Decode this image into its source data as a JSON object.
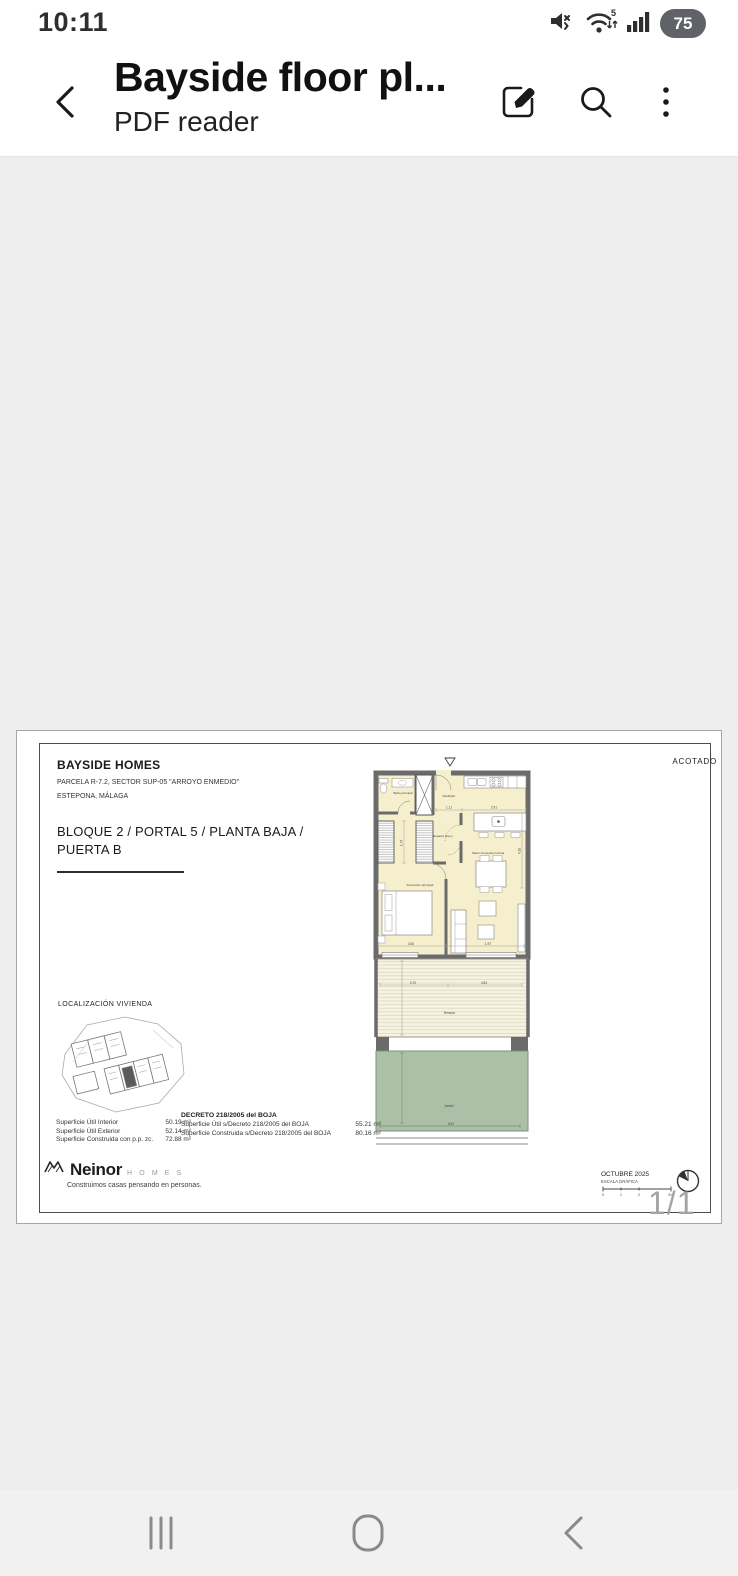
{
  "status_bar": {
    "time": "10:11",
    "battery_level": "75",
    "wifi_label": "5"
  },
  "header": {
    "title": "Bayside floor pl...",
    "subtitle": "PDF reader"
  },
  "viewer": {
    "page_indicator": "1/1"
  },
  "pdf": {
    "acotado": "ACOTADO",
    "project": {
      "name": "BAYSIDE HOMES",
      "address_line1": "PARCELA R-7.2, SECTOR SUP-05 \"ARROYO ENMEDIO\"",
      "address_line2": "ESTEPONA, MÁLAGA"
    },
    "unit": {
      "line1": "BLOQUE 2 / PORTAL 5 / PLANTA BAJA /",
      "line2": "PUERTA B"
    },
    "localizacion_title": "LOCALIZACIÓN VIVIENDA",
    "plan": {
      "rooms": {
        "bano": "Baño principal",
        "recibidor": "Recibidor",
        "espacio": "Espacio Homy",
        "salon": "Salón-Comedor-Cocina",
        "dormitorio": "Dormitorio principal",
        "terraza": "Terraza",
        "jardin": "Jardín"
      },
      "dims": {
        "recibidor": "1.11",
        "cocina": "2.91",
        "pasillo": "1.74",
        "salon_alto": "4.10",
        "dormitorio": "3.50",
        "salon": "1.97",
        "terraza_izq": "3.70",
        "terraza_der": "4.52",
        "jardin": "6.52"
      }
    },
    "areas": {
      "rows": [
        {
          "label": "Superficie Útil Interior",
          "value": "50.19 m²"
        },
        {
          "label": "Superficie Útil Exterior",
          "value": "52.14 m²"
        },
        {
          "label": "Superficie Construida con p.p. zc.",
          "value": "72.88 m²"
        }
      ],
      "decreto_title": "DECRETO 218/2005 del BOJA",
      "decreto_rows": [
        {
          "label": "Superficie Útil s/Decreto 218/2005 del BOJA",
          "value": "55.21 m²"
        },
        {
          "label": "Superficie Construida s/Decreto 218/2005 del BOJA",
          "value": "80.16 m²"
        }
      ]
    },
    "footer": {
      "brand": "Neinor",
      "brand_sub": "H O M E S",
      "tagline": "Construimos casas pensando en personas.",
      "date": "OCTUBRE 2025",
      "scale_label": "ESCALA GRÁFICA",
      "scale_ticks": [
        "0",
        "1",
        "2",
        "5m"
      ]
    }
  },
  "colors": {
    "interior": "#f6efcd",
    "terrace": "#f7f3e2",
    "garden": "#abc0a6",
    "wall": "#6b6b6b",
    "page_bg": "#eeeeee"
  }
}
